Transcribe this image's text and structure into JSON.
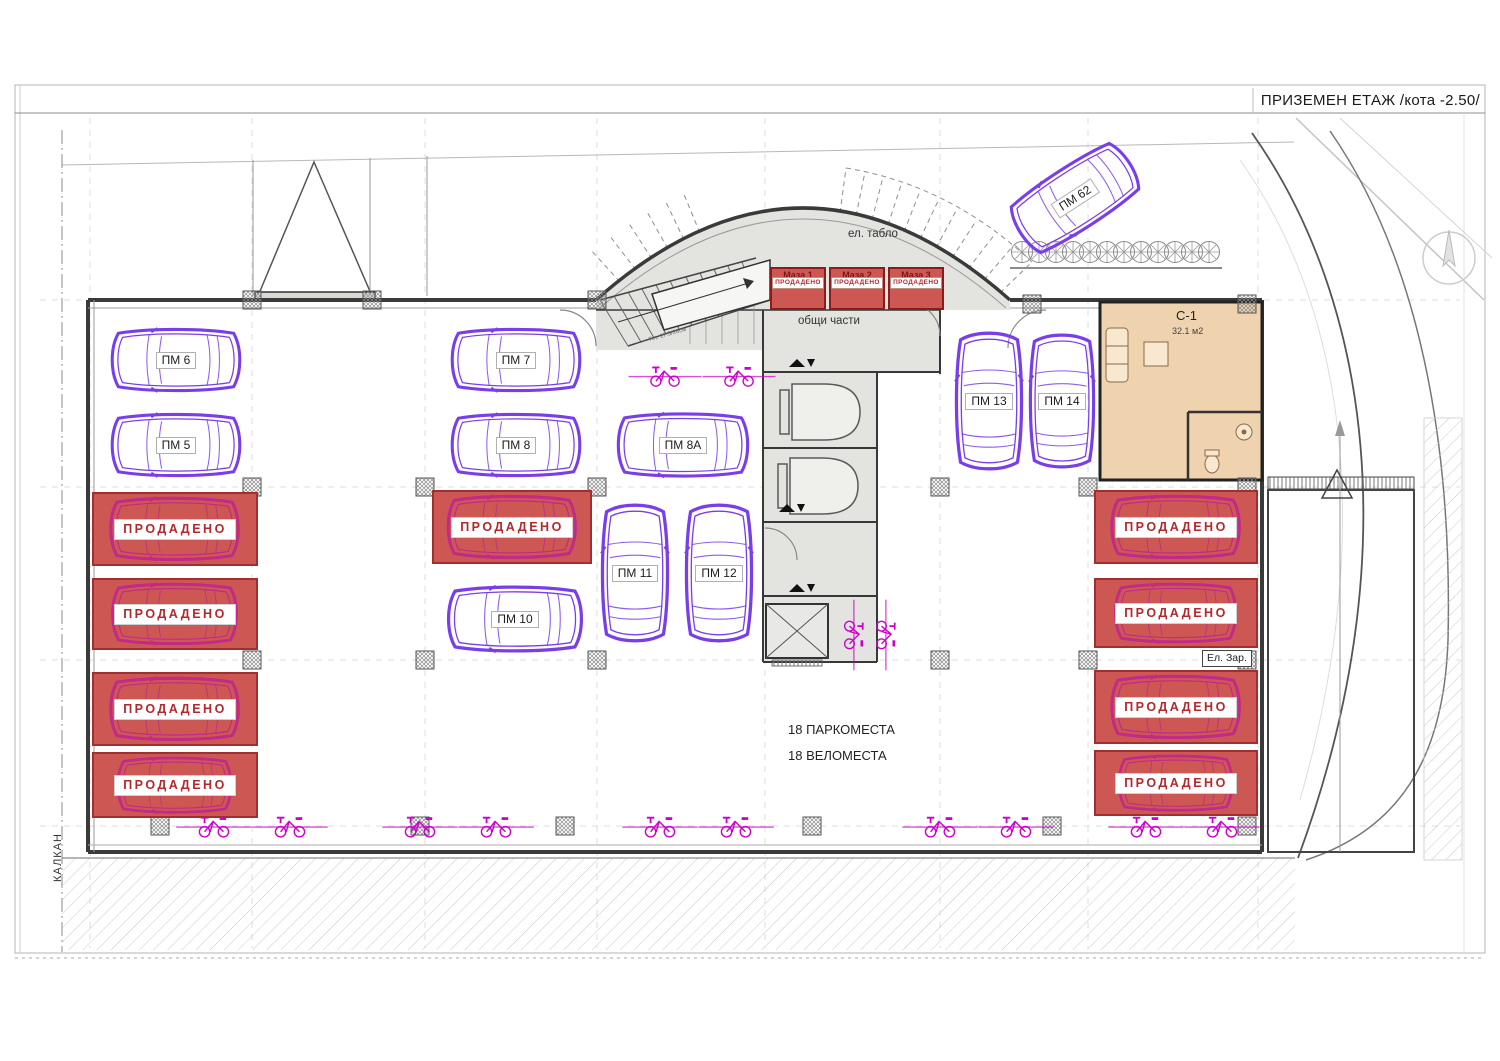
{
  "title": "ПРИЗЕМЕН ЕТАЖ  /кота -2.50/",
  "labels": {
    "sold": "ПРОДАДЕНО",
    "el_tablo": "ел. табло",
    "common_areas": "общи части",
    "el_charge": "Ел. Зар.",
    "kalkan": "КАЛКАН",
    "parking_count": "18 ПАРКОМЕСТА",
    "bike_count": "18 ВЕЛОМЕСТА",
    "stairs_note": "7ст. 17.5/28см"
  },
  "unit_c1": {
    "name": "С-1",
    "area": "32.1 м2"
  },
  "storage_units": [
    {
      "name": "Маза 1"
    },
    {
      "name": "Маза 2"
    },
    {
      "name": "Маза 3"
    }
  ],
  "parking_spots": [
    {
      "label": "ПМ 5"
    },
    {
      "label": "ПМ 6"
    },
    {
      "label": "ПМ 7"
    },
    {
      "label": "ПМ 8"
    },
    {
      "label": "ПМ 8А"
    },
    {
      "label": "ПМ 10"
    },
    {
      "label": "ПМ 11"
    },
    {
      "label": "ПМ 12"
    },
    {
      "label": "ПМ 13"
    },
    {
      "label": "ПМ 14"
    },
    {
      "label": "ПМ 62"
    }
  ],
  "colors": {
    "sold-red": "#cd5853",
    "sold-border": "#a03030",
    "sold-car": "#c12a86",
    "sold-text": "#b3282d",
    "car-purple": "#7a3ee8",
    "bike-magenta": "#cc00cc",
    "unit-tan": "#eed3ae",
    "wall-dark": "#3a3a3a",
    "core-gray": "#e3e3e0"
  }
}
